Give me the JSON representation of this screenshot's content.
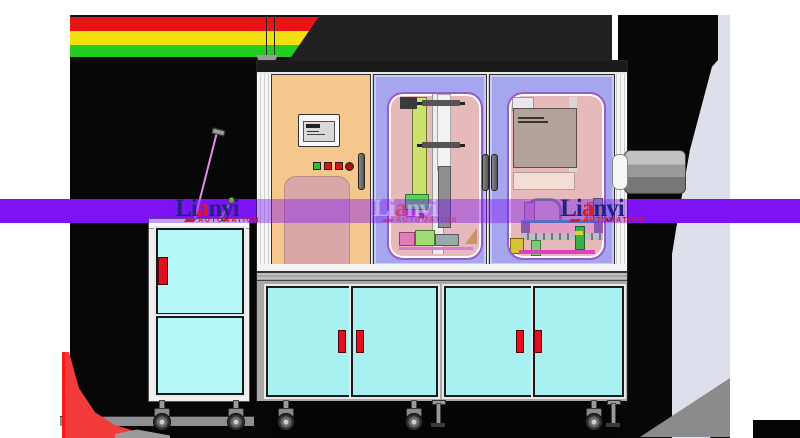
{
  "watermark": {
    "part1": "Li",
    "letter_a": "a",
    "part2": "nyi",
    "subtitle": "AUTOMATION",
    "instances": [
      "left",
      "center",
      "right"
    ]
  },
  "colors": {
    "watermark-band": "#7d13f3",
    "tower-red": "#e81416",
    "tower-yellow": "#f1df10",
    "tower-green": "#23cd23",
    "door-orange": "#f5c78d",
    "door-periwinkle": "#a6a6ee",
    "window-pink": "#e6baba",
    "panel-pink": "#d9a7a7",
    "cabinet-cyan": "#a9f1f1",
    "handle-red": "#e0101e",
    "frame-gray": "#a8a8a8",
    "hmi-green": "#2bbf2b",
    "hmi-red": "#dd1414"
  }
}
